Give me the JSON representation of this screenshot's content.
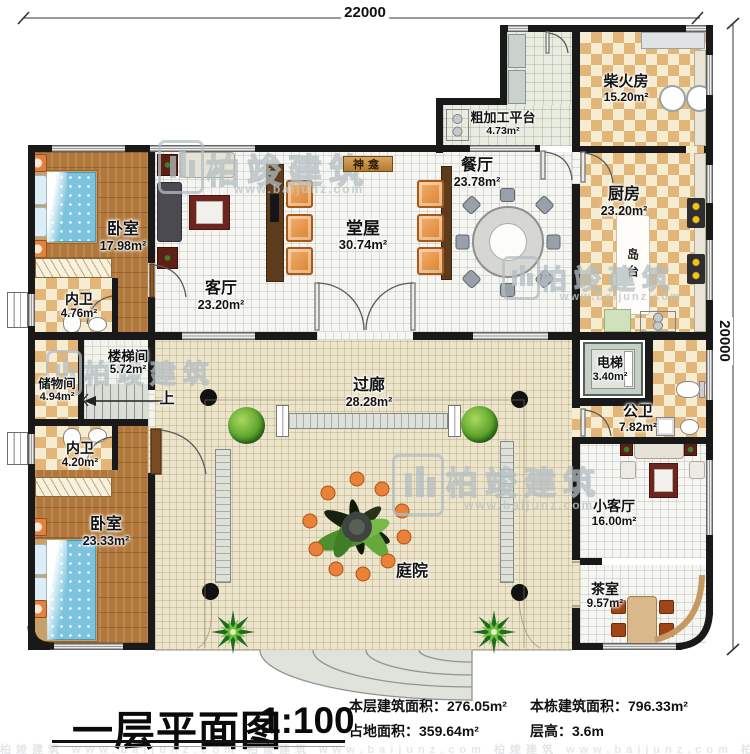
{
  "dimensions": {
    "width": "22000",
    "height": "20000"
  },
  "rooms": {
    "bedroom_top": {
      "name": "卧室",
      "area": "17.98m²"
    },
    "bath_top": {
      "name": "内卫",
      "area": "4.76m²"
    },
    "stairwell": {
      "name": "楼梯间",
      "area": "5.72m²"
    },
    "storage": {
      "name": "储物间",
      "area": "4.94m²"
    },
    "bath_bottom": {
      "name": "内卫",
      "area": "4.20m²"
    },
    "bedroom_bottom": {
      "name": "卧室",
      "area": "23.33m²"
    },
    "living": {
      "name": "客厅",
      "area": "23.20m²"
    },
    "hall": {
      "name": "堂屋",
      "area": "30.74m²"
    },
    "shrine": {
      "name": "神龛"
    },
    "dining": {
      "name": "餐厅",
      "area": "23.78m²"
    },
    "prep_platform": {
      "name": "粗加工平台",
      "area": "4.73m²"
    },
    "firewood": {
      "name": "柴火房",
      "area": "15.20m²"
    },
    "kitchen": {
      "name": "厨房",
      "area": "23.20m²"
    },
    "island": {
      "name": "岛台"
    },
    "elevator": {
      "name": "电梯",
      "area": "3.40m²"
    },
    "public_bath": {
      "name": "公卫",
      "area": "7.82m²"
    },
    "small_living": {
      "name": "小客厅",
      "area": "16.00m²"
    },
    "tea_room": {
      "name": "茶室",
      "area": "9.57m²"
    },
    "corridor": {
      "name": "过廊",
      "area": "28.28m²"
    },
    "courtyard": {
      "name": "庭院"
    },
    "stairs_up": "上"
  },
  "title": {
    "name": "一层平面图",
    "scale": "1:100"
  },
  "stats": {
    "floor_area_label": "本层建筑面积：",
    "floor_area_value": "276.05m²",
    "total_area_label": "本栋建筑面积：",
    "total_area_value": "796.33m²",
    "land_area_label": "占地面积：",
    "land_area_value": "359.64m²",
    "floor_height_label": "层高：",
    "floor_height_value": "3.6m"
  },
  "watermark": {
    "brand": "柏竣建筑",
    "url": "www.baijunz.com",
    "strip": "柏竣建筑 www.baijunz.com   柏竣建筑 www.baijunz.com   柏竣建筑 www.baijunz.com   柏竣建筑 www.baijunz.com"
  },
  "palette": {
    "wall": "#1a1a1a",
    "wood_floor": "#b0783c",
    "tile_checker": "#e2b678",
    "courtyard": "#ece4cb",
    "chair_orange": "#e8964f",
    "bed_blue": "#7cc4de",
    "tree_fruit": "#e8823a"
  }
}
